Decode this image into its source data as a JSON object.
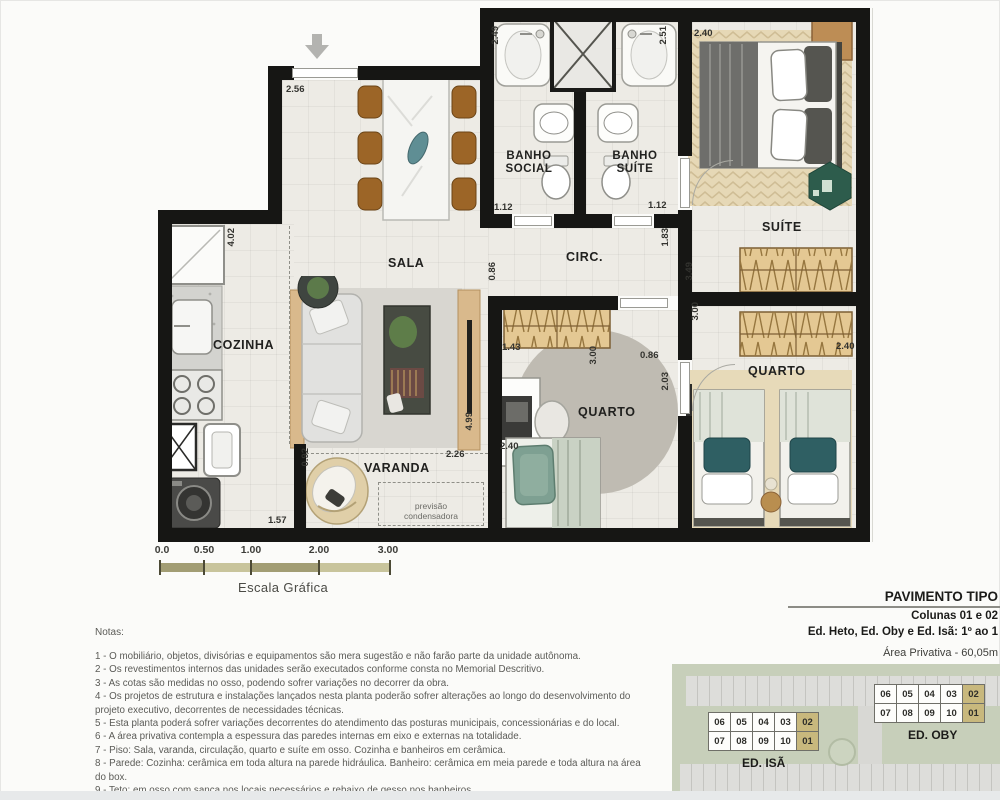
{
  "plan": {
    "rooms": {
      "sala": "SALA",
      "cozinha": "COZINHA",
      "varanda": "VARANDA",
      "banho_social": "BANHO SOCIAL",
      "banho_suite": "BANHO SUÍTE",
      "circ": "CIRC.",
      "suite": "SUÍTE",
      "quarto_meio": "QUARTO",
      "quarto_fundo": "QUARTO"
    },
    "annotations": {
      "condensadora": "previsão condensadora"
    },
    "dims": {
      "entrada": "2.56",
      "banho_social_prof": "2.49",
      "banho_suite_prof": "2.51",
      "suite_larg": "2.40",
      "cozinha_comp": "4.02",
      "porta_banho_social": "1.12",
      "porta_banho_suite": "1.12",
      "circ_suite": "1.83",
      "abertura_sala_circ": "0.86",
      "suite_parede": "3.49",
      "quarto_fundo_parede": "3.00",
      "armario_quarto": "1.43",
      "quarto_meio_parede": "3.00",
      "porta_quarto": "0.86",
      "quarto_meio_prof": "2.03",
      "sala_comp": "4.99",
      "varanda_larg": "2.26",
      "varanda_prof": "0.92",
      "cozinha_larg": "1.57",
      "bancada_quarto": "2.40",
      "quarto_fundo_larg": "2.40"
    }
  },
  "scalebar": {
    "ticks": [
      "0.0",
      "0.50",
      "1.00",
      "2.00",
      "3.00"
    ],
    "caption": "Escala Gráfica"
  },
  "notes": {
    "title": "Notas:",
    "items": [
      "1 - O mobiliário, objetos, divisórias e equipamentos são mera sugestão e não farão parte da unidade autônoma.",
      "2 - Os revestimentos internos das unidades serão executados conforme consta no Memorial Descritivo.",
      "3 - As cotas são medidas no osso, podendo sofrer variações no decorrer da obra.",
      "4 - Os projetos de estrutura e instalações lançados nesta planta poderão sofrer alterações ao longo do desenvolvimento do projeto executivo, decorrentes de necessidades técnicas.",
      "5 - Esta planta poderá sofrer variações decorrentes do atendimento das posturas municipais, concessionárias e do local.",
      "6 - A área privativa contempla a espessura das paredes internas em eixo e externas na totalidade.",
      "7 - Piso: Sala, varanda, circulação, quarto e suíte em osso. Cozinha e banheiros em cerâmica.",
      "8 - Parede: Cozinha: cerâmica em toda altura na parede hidráulica. Banheiro: cerâmica em meia parede e toda altura na área do box.",
      "9 - Teto: em osso com sanca nos locais necessários e rebaixo de gesso nos banheiros.",
      "10 - Louça: lavatórios e tanque com coluna.",
      "11 - Ar-condicionado: previsão para instalação de ar-condicionado tipo multi split, com ponto elétrico e dreno, que deverá ser instalado conforme projeto."
    ]
  },
  "panel": {
    "title": "PAVIMENTO TIPO",
    "subtitle": "Colunas 01 e 02",
    "buildings_line": "Ed. Heto, Ed. Oby e Ed. Isã: 1º ao 1",
    "area_line": "Área Privativa - 60,05m"
  },
  "keyplan": {
    "highlight_color": "#c8b87d",
    "buildings": [
      {
        "name": "ED. ISÃ",
        "rows": [
          [
            "06",
            "05",
            "04",
            "03",
            "02"
          ],
          [
            "07",
            "08",
            "09",
            "10",
            "01"
          ]
        ]
      },
      {
        "name": "ED. OBY",
        "rows": [
          [
            "06",
            "05",
            "04",
            "03",
            "02"
          ],
          [
            "07",
            "08",
            "09",
            "10",
            "01"
          ]
        ]
      }
    ]
  }
}
